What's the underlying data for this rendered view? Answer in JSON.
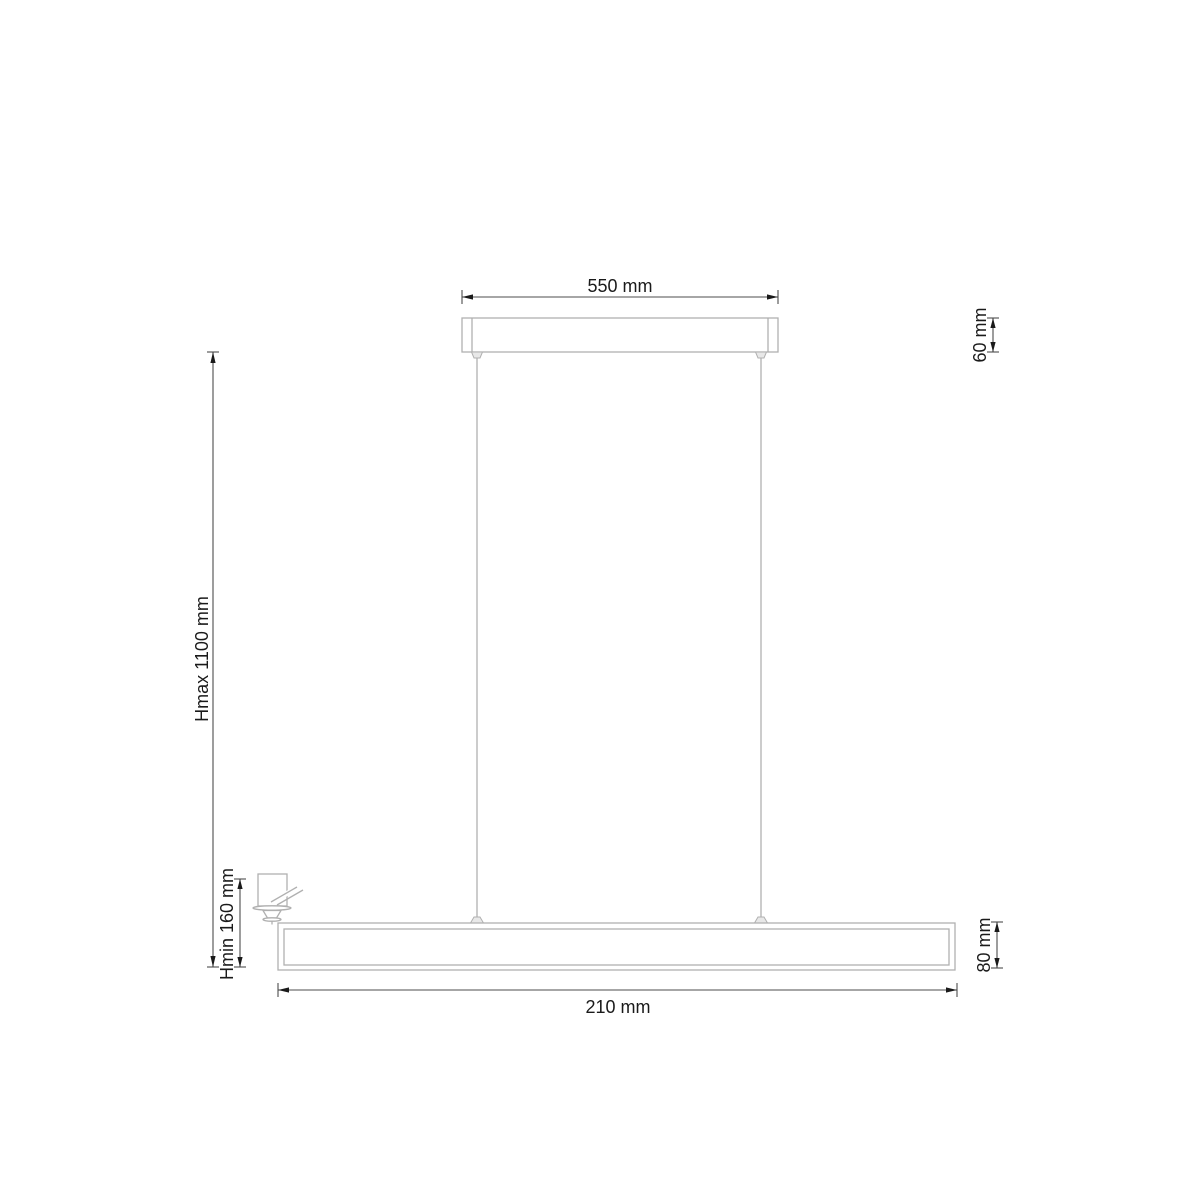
{
  "drawing": {
    "labels": {
      "canopy_width": "550 mm",
      "canopy_height": "60 mm",
      "max_height": "Hmax 1100 mm",
      "min_height": "Hmin 160 mm",
      "fixture_length": "210 mm",
      "fixture_height": "80 mm"
    },
    "colors": {
      "background": "#ffffff",
      "outline": "#b0b0b0",
      "dimension_line": "#4d4d4d",
      "arrow": "#1a1a1a",
      "text": "#1a1a1a"
    }
  }
}
